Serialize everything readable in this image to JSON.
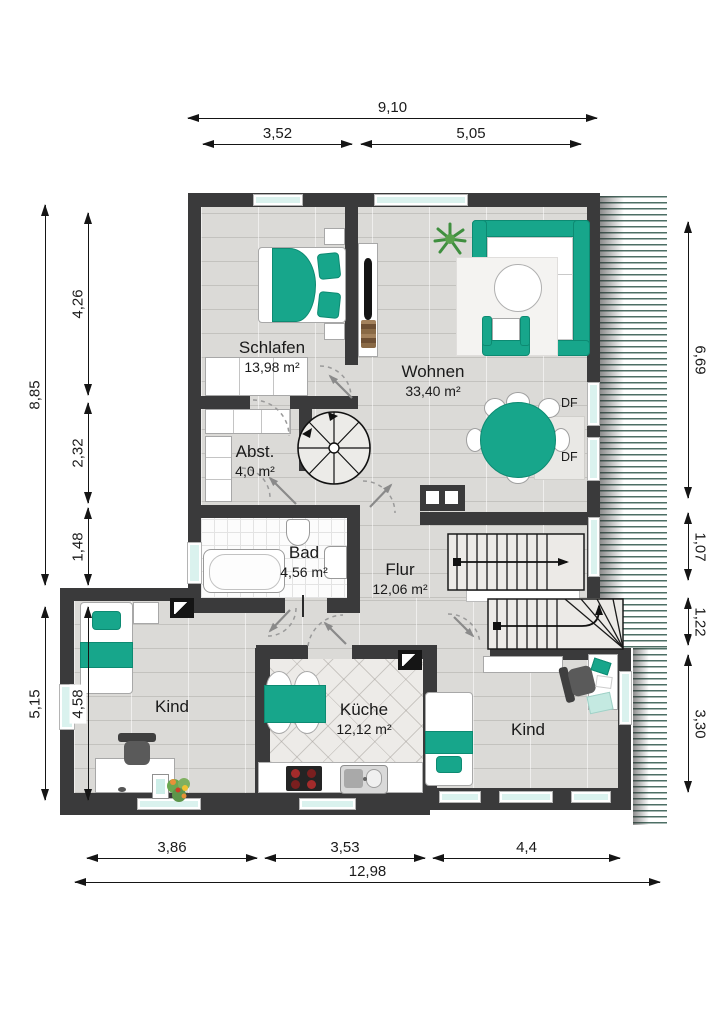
{
  "colors": {
    "accent": "#17a68b",
    "wall": "#3a3a3b",
    "window": "#daf2ee",
    "hatch_line": "#4d6f65"
  },
  "dims": {
    "top_total": "9,10",
    "top_left": "3,52",
    "top_right": "5,05",
    "left_total": "8,85",
    "left_1": "4,26",
    "left_2": "2,32",
    "left_3": "1,48",
    "left_lower_outer": "5,15",
    "left_lower_inner": "4,58",
    "right_1": "6,69",
    "right_2": "1,07",
    "right_3": "1,22",
    "right_4": "3,30",
    "bottom_1": "3,86",
    "bottom_2": "3,53",
    "bottom_3": "4,4",
    "bottom_total": "12,98"
  },
  "rooms": {
    "schlafen": {
      "name": "Schlafen",
      "area": "13,98 m²"
    },
    "wohnen": {
      "name": "Wohnen",
      "area": "33,40 m²"
    },
    "abstellraum": {
      "name": "Abst.",
      "area": "4,0 m²"
    },
    "bad": {
      "name": "Bad",
      "area": "4,56 m²"
    },
    "flur": {
      "name": "Flur",
      "area": "12,06 m²"
    },
    "kind_links": {
      "name": "Kind"
    },
    "kueche": {
      "name": "Küche",
      "area": "12,12 m²"
    },
    "kind_rechts": {
      "name": "Kind"
    }
  },
  "labels": {
    "roof_window": "DF"
  }
}
